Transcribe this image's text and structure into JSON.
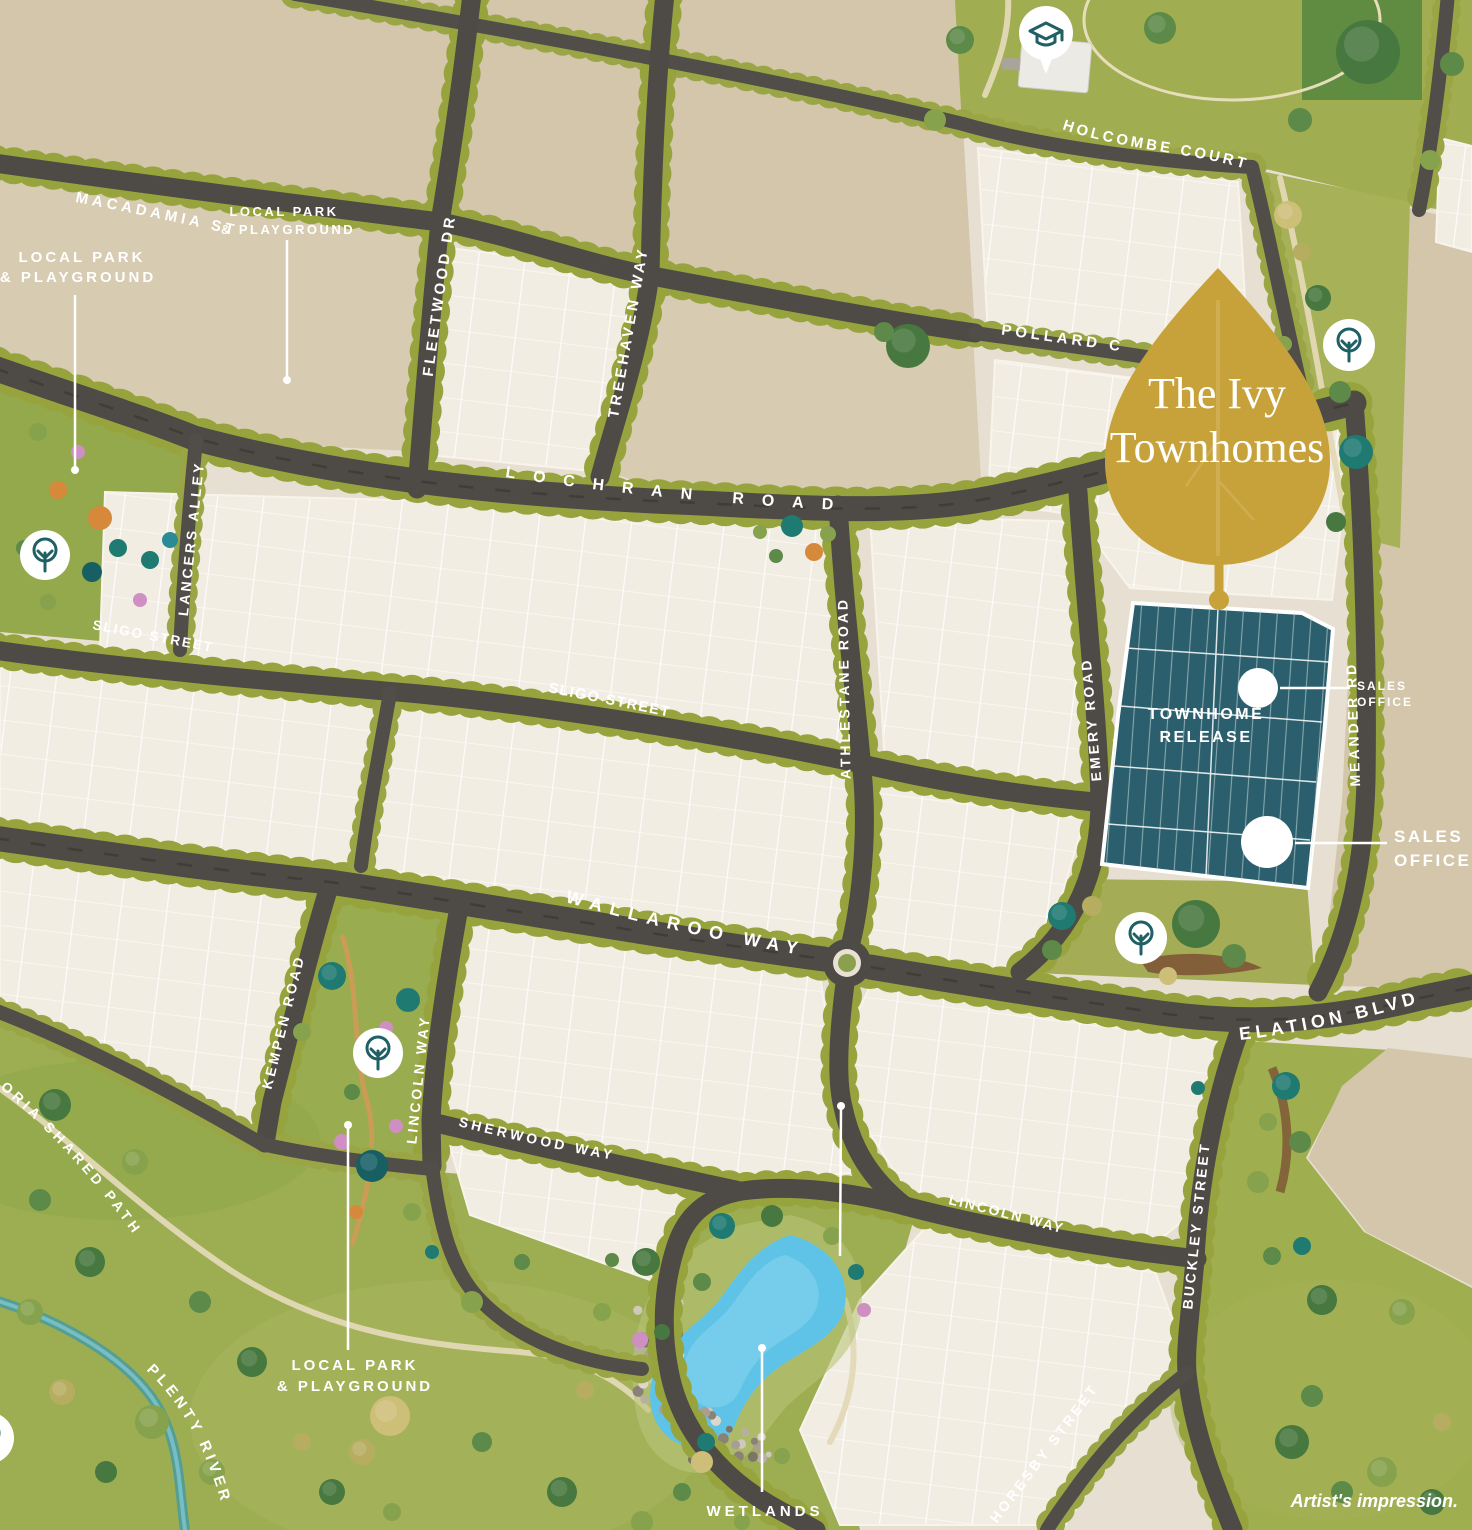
{
  "title": "The Ivy Townhomes masterplan map",
  "leaf": {
    "line1": "The Ivy",
    "line2": "Townhomes"
  },
  "roads": {
    "macadamia": "MACADAMIA ST",
    "fleetwood": "FLEETWOOD DR",
    "treehaven": "TREEHAVEN WAY",
    "holcombe": "HOLCOMBE COURT",
    "pollard": "POLLARD C",
    "lochran": "LOCHRAN ROAD",
    "lancers": "LANCERS ALLEY",
    "sligo": "SLIGO STREET",
    "athlestane": "ATHLESTANE ROAD",
    "emery": "EMERY ROAD",
    "meander": "MEANDER RD",
    "wallaroo": "WALLAROO WAY",
    "elation": "ELATION BLVD",
    "kempen": "KEMPEN ROAD",
    "lincoln": "LINCOLN WAY",
    "sherwood": "SHERWOOD WAY",
    "buckley": "BUCKLEY STREET",
    "horesby": "HORESBY STREET",
    "plenty_river": "PLENTY RIVER",
    "shared_path": "ORIA SHARED PATH"
  },
  "callouts": {
    "local_park": {
      "line1": "LOCAL PARK",
      "line2": "& PLAYGROUND"
    },
    "wetlands": "WETLANDS",
    "release": {
      "line1": "TOWNHOME",
      "line2": "RELEASE"
    },
    "sales_office": {
      "line1": "SALES",
      "line2": "OFFICE"
    },
    "artists_impression": "Artist's impression."
  },
  "icons": {
    "info_glyph": "i"
  },
  "colors": {
    "leaf_gold": "#c7a23b",
    "release_teal": "#2c5f6d",
    "icon_teal": "#1f6065",
    "lake_blue": "#5fc3e7",
    "road": "#4e4a45",
    "street_tree": "#97a43e",
    "tan": "#d3c6aa",
    "lot_cream": "#f2ede3",
    "label_white": "#ffffff"
  }
}
